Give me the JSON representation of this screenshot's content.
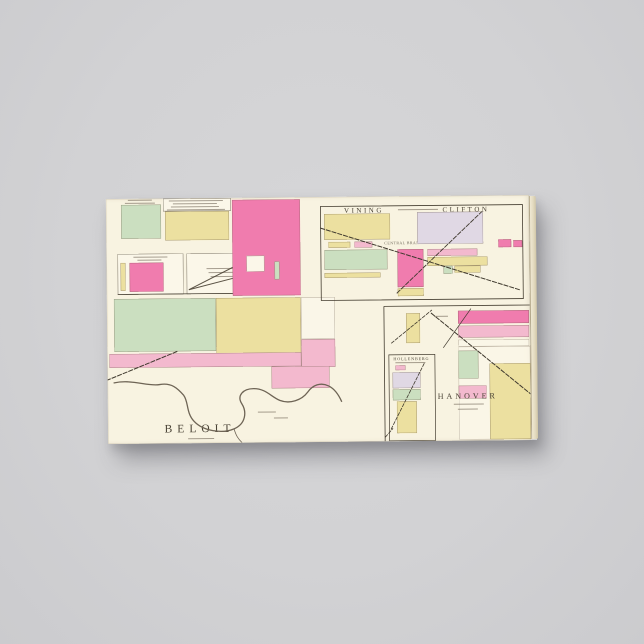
{
  "scene": {
    "background_color": "#d2d2d4",
    "canvas_paper_color": "#f8f3e1"
  },
  "map": {
    "towns": {
      "beloit": "BELOIT",
      "vining": "VINING",
      "clifton": "CLIFTON",
      "hanover": "HANOVER",
      "hollenberg": "HOLLENBERG"
    },
    "annotations": {
      "railroad": "CENTRAL BRANCH U.P.R.R."
    },
    "palette": {
      "pink_strong": "#f07cae",
      "pink_light": "#f3b9ce",
      "yellow": "#ece0a0",
      "green": "#cbdfc0",
      "lavender": "#e0d8e4",
      "ink": "#453e31"
    }
  }
}
